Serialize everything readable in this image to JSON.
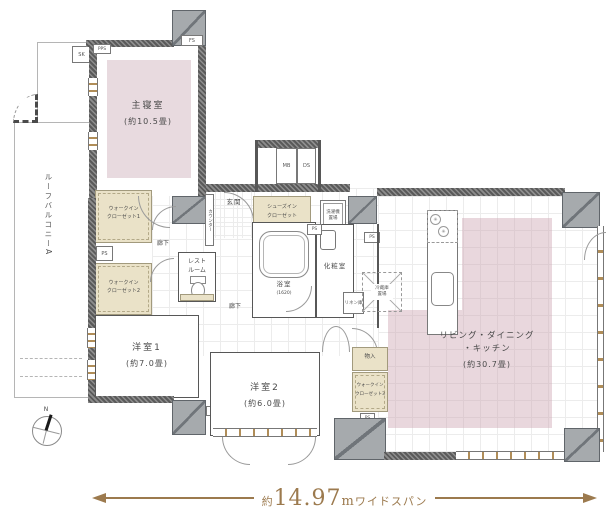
{
  "labels": {
    "master_bedroom": "主寝室",
    "master_bedroom_size": "(約10.5畳)",
    "roof_balcony": "ルーフバルコニーA",
    "wic_line1": "ウォークイン",
    "wic1_line2": "クローゼット1",
    "wic2_line2": "クローゼット2",
    "wic3_line2": "クローゼット3",
    "corridor": "廊下",
    "restroom_line1": "レスト",
    "restroom_line2": "ルーム",
    "entrance": "玄関",
    "counter": "カウンター",
    "shoe_closet_line1": "シューズイン",
    "shoe_closet_line2": "クローゼット",
    "washer_line1": "洗濯機",
    "washer_line2": "置場",
    "bathroom": "浴室",
    "bathroom_size": "(1620)",
    "powder_room": "化粧室",
    "linen": "リネン庫",
    "fridge_line1": "冷蔵庫",
    "fridge_line2": "置場",
    "storage": "物入",
    "ldk_line1": "リビング・ダイニング",
    "ldk_line2": "・キッチン",
    "ldk_size": "(約30.7畳)",
    "room1": "洋室1",
    "room1_size": "(約7.0畳)",
    "room2": "洋室2",
    "room2_size": "(約6.0畳)",
    "mb": "MB",
    "ds": "DS",
    "ps": "PS",
    "pps": "PPS",
    "fs": "FS",
    "sk": "SK",
    "north": "N",
    "burner": "✳"
  },
  "dimension": {
    "prefix": "約",
    "value": "14.97",
    "unit": "m",
    "suffix": "ワイドスパン"
  },
  "colors": {
    "accent_brown": "#9c7a4e",
    "room_pink": "#e8dadf",
    "ldk_pink": "rgba(203,160,173,0.42)",
    "closet_beige": "#eae2c8",
    "wall_dark": "#5a5a5a",
    "pillar_gray": "#a6aaad"
  }
}
